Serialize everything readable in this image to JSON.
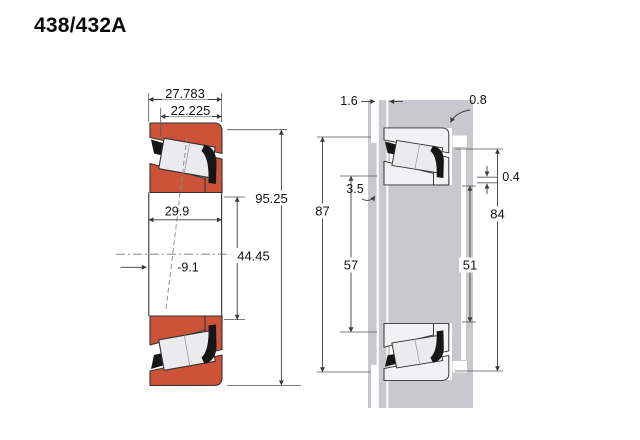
{
  "title": "438/432A",
  "left_figure": {
    "label": "bearing cross-section",
    "dimensions": {
      "total_width": "27.783",
      "cone_width": "22.225",
      "outer_diameter": "95.25",
      "cage_width": "29.9",
      "bore_diameter": "44.45",
      "load_center": "-9.1"
    }
  },
  "right_figure": {
    "label": "mounting dimensions",
    "dimensions": {
      "shoulder_clearance": "1.6",
      "housing_fillet_radius": "0.8",
      "shaft_fillet_radius": "3.5",
      "housing_abutment_outer": "87",
      "shaft_shoulder_diameter": "57",
      "shaft_abutment_diameter": "51",
      "housing_shoulder_diameter": "84",
      "axial_standout": "0.4"
    }
  },
  "colors": {
    "ring_fill": "#cd5338",
    "steel_gray": "#c9c9cd",
    "dimension_line": "#3c3c3c"
  }
}
